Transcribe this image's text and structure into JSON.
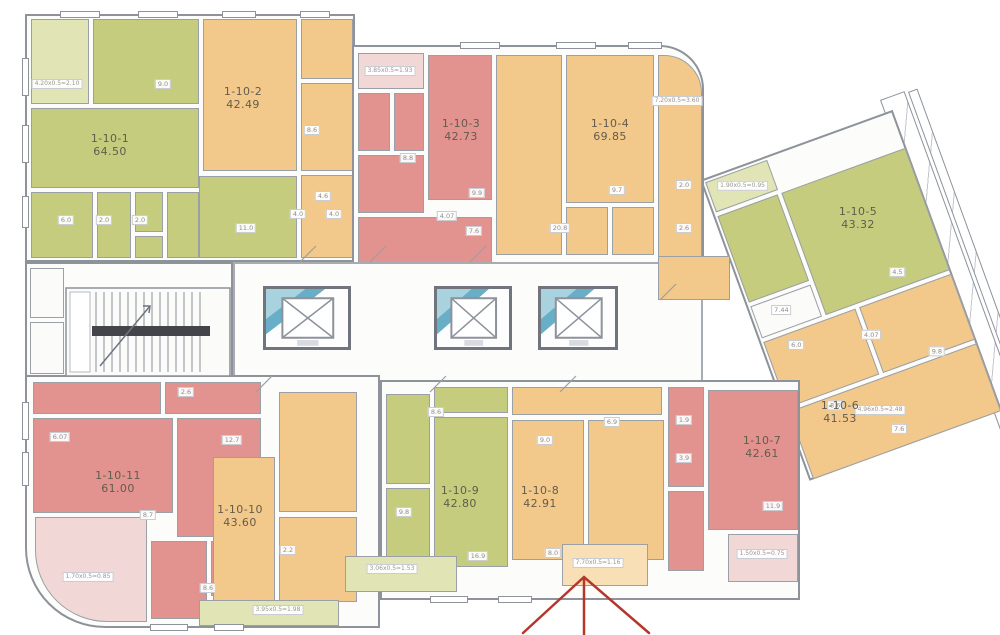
{
  "colors": {
    "green": "#c6cc7d",
    "green_light": "#e1e4b5",
    "orange": "#f3c88b",
    "orange_pale": "#f8dfb6",
    "pink": "#e2928f",
    "pink_light": "#f1d7d5",
    "wall": "#8d929b",
    "elevator_teal": "#57a5c0",
    "arrow_red": "#b5372c"
  },
  "apartments": [
    {
      "id": "1-10-1",
      "area": "64.50",
      "x": 110,
      "y": 145,
      "color": "green"
    },
    {
      "id": "1-10-2",
      "area": "42.49",
      "x": 243,
      "y": 98,
      "color": "orange"
    },
    {
      "id": "1-10-3",
      "area": "42.73",
      "x": 461,
      "y": 130,
      "color": "pink"
    },
    {
      "id": "1-10-4",
      "area": "69.85",
      "x": 610,
      "y": 130,
      "color": "orange"
    },
    {
      "id": "1-10-5",
      "area": "43.32",
      "x": 858,
      "y": 218,
      "color": "green"
    },
    {
      "id": "1-10-6",
      "area": "41.53",
      "x": 840,
      "y": 412,
      "color": "orange"
    },
    {
      "id": "1-10-7",
      "area": "42.61",
      "x": 762,
      "y": 447,
      "color": "pink"
    },
    {
      "id": "1-10-8",
      "area": "42.91",
      "x": 540,
      "y": 497,
      "color": "orange"
    },
    {
      "id": "1-10-9",
      "area": "42.80",
      "x": 460,
      "y": 497,
      "color": "green"
    },
    {
      "id": "1-10-10",
      "area": "43.60",
      "x": 240,
      "y": 516,
      "color": "orange"
    },
    {
      "id": "1-10-11",
      "area": "61.00",
      "x": 118,
      "y": 482,
      "color": "pink"
    }
  ],
  "balcony_labels": [
    {
      "text": "4.20х0.5=2.10",
      "x": 57,
      "y": 84
    },
    {
      "text": "3.85х0.5=1.93",
      "x": 390,
      "y": 71
    },
    {
      "text": "7.20х0.5=3.60",
      "x": 677,
      "y": 101
    },
    {
      "text": "1.90х0.5=0.95",
      "x": 36,
      "y": 18,
      "parent": "rightwing"
    },
    {
      "text": "4.96х0.5=2.48",
      "x": 880,
      "y": 410
    },
    {
      "text": "7.70х0.5=1.16",
      "x": 598,
      "y": 563
    },
    {
      "text": "1.50х0.5=0.75",
      "x": 762,
      "y": 554
    },
    {
      "text": "3.06х0.5=1.53",
      "x": 392,
      "y": 569
    },
    {
      "text": "3.95х0.5=1.98",
      "x": 278,
      "y": 610
    },
    {
      "text": "1.70х0.5=0.85",
      "x": 88,
      "y": 577
    }
  ],
  "room_tags": [
    {
      "text": "9.0",
      "x": 163,
      "y": 84
    },
    {
      "text": "8.6",
      "x": 312,
      "y": 130
    },
    {
      "text": "6.0",
      "x": 66,
      "y": 220
    },
    {
      "text": "2.0",
      "x": 104,
      "y": 220
    },
    {
      "text": "2.0",
      "x": 140,
      "y": 220
    },
    {
      "text": "11.0",
      "x": 246,
      "y": 228
    },
    {
      "text": "4.0",
      "x": 298,
      "y": 214
    },
    {
      "text": "4.0",
      "x": 334,
      "y": 214
    },
    {
      "text": "4.6",
      "x": 323,
      "y": 196
    },
    {
      "text": "8.8",
      "x": 408,
      "y": 158
    },
    {
      "text": "4.07",
      "x": 447,
      "y": 216
    },
    {
      "text": "9.9",
      "x": 477,
      "y": 193
    },
    {
      "text": "7.6",
      "x": 474,
      "y": 231
    },
    {
      "text": "20.8",
      "x": 560,
      "y": 228
    },
    {
      "text": "9.7",
      "x": 617,
      "y": 190
    },
    {
      "text": "2.0",
      "x": 684,
      "y": 185
    },
    {
      "text": "2.6",
      "x": 684,
      "y": 228
    },
    {
      "text": "7.44",
      "x": 30,
      "y": 148,
      "parent": "rightwing"
    },
    {
      "text": "4.5",
      "x": 152,
      "y": 152,
      "parent": "rightwing"
    },
    {
      "text": "6.0",
      "x": 32,
      "y": 186,
      "parent": "rightwing"
    },
    {
      "text": "4.07",
      "x": 106,
      "y": 202,
      "parent": "rightwing"
    },
    {
      "text": "8.6",
      "x": 48,
      "y": 256,
      "parent": "rightwing"
    },
    {
      "text": "9.8",
      "x": 162,
      "y": 240,
      "parent": "rightwing"
    },
    {
      "text": "7.6",
      "x": 100,
      "y": 300,
      "parent": "rightwing"
    },
    {
      "text": "8.6",
      "x": 436,
      "y": 412
    },
    {
      "text": "9.8",
      "x": 404,
      "y": 512
    },
    {
      "text": "16.9",
      "x": 478,
      "y": 556
    },
    {
      "text": "9.0",
      "x": 545,
      "y": 440
    },
    {
      "text": "6.9",
      "x": 612,
      "y": 422
    },
    {
      "text": "8.0",
      "x": 553,
      "y": 553
    },
    {
      "text": "1.9",
      "x": 684,
      "y": 420
    },
    {
      "text": "3.9",
      "x": 684,
      "y": 458
    },
    {
      "text": "11.9",
      "x": 773,
      "y": 506
    },
    {
      "text": "6.07",
      "x": 60,
      "y": 437
    },
    {
      "text": "12.7",
      "x": 232,
      "y": 440
    },
    {
      "text": "8.7",
      "x": 148,
      "y": 515
    },
    {
      "text": "2.2",
      "x": 288,
      "y": 550
    },
    {
      "text": "8.6",
      "x": 208,
      "y": 588
    },
    {
      "text": "2.6",
      "x": 186,
      "y": 392
    }
  ],
  "arrow": {
    "color": "#b5372c"
  }
}
